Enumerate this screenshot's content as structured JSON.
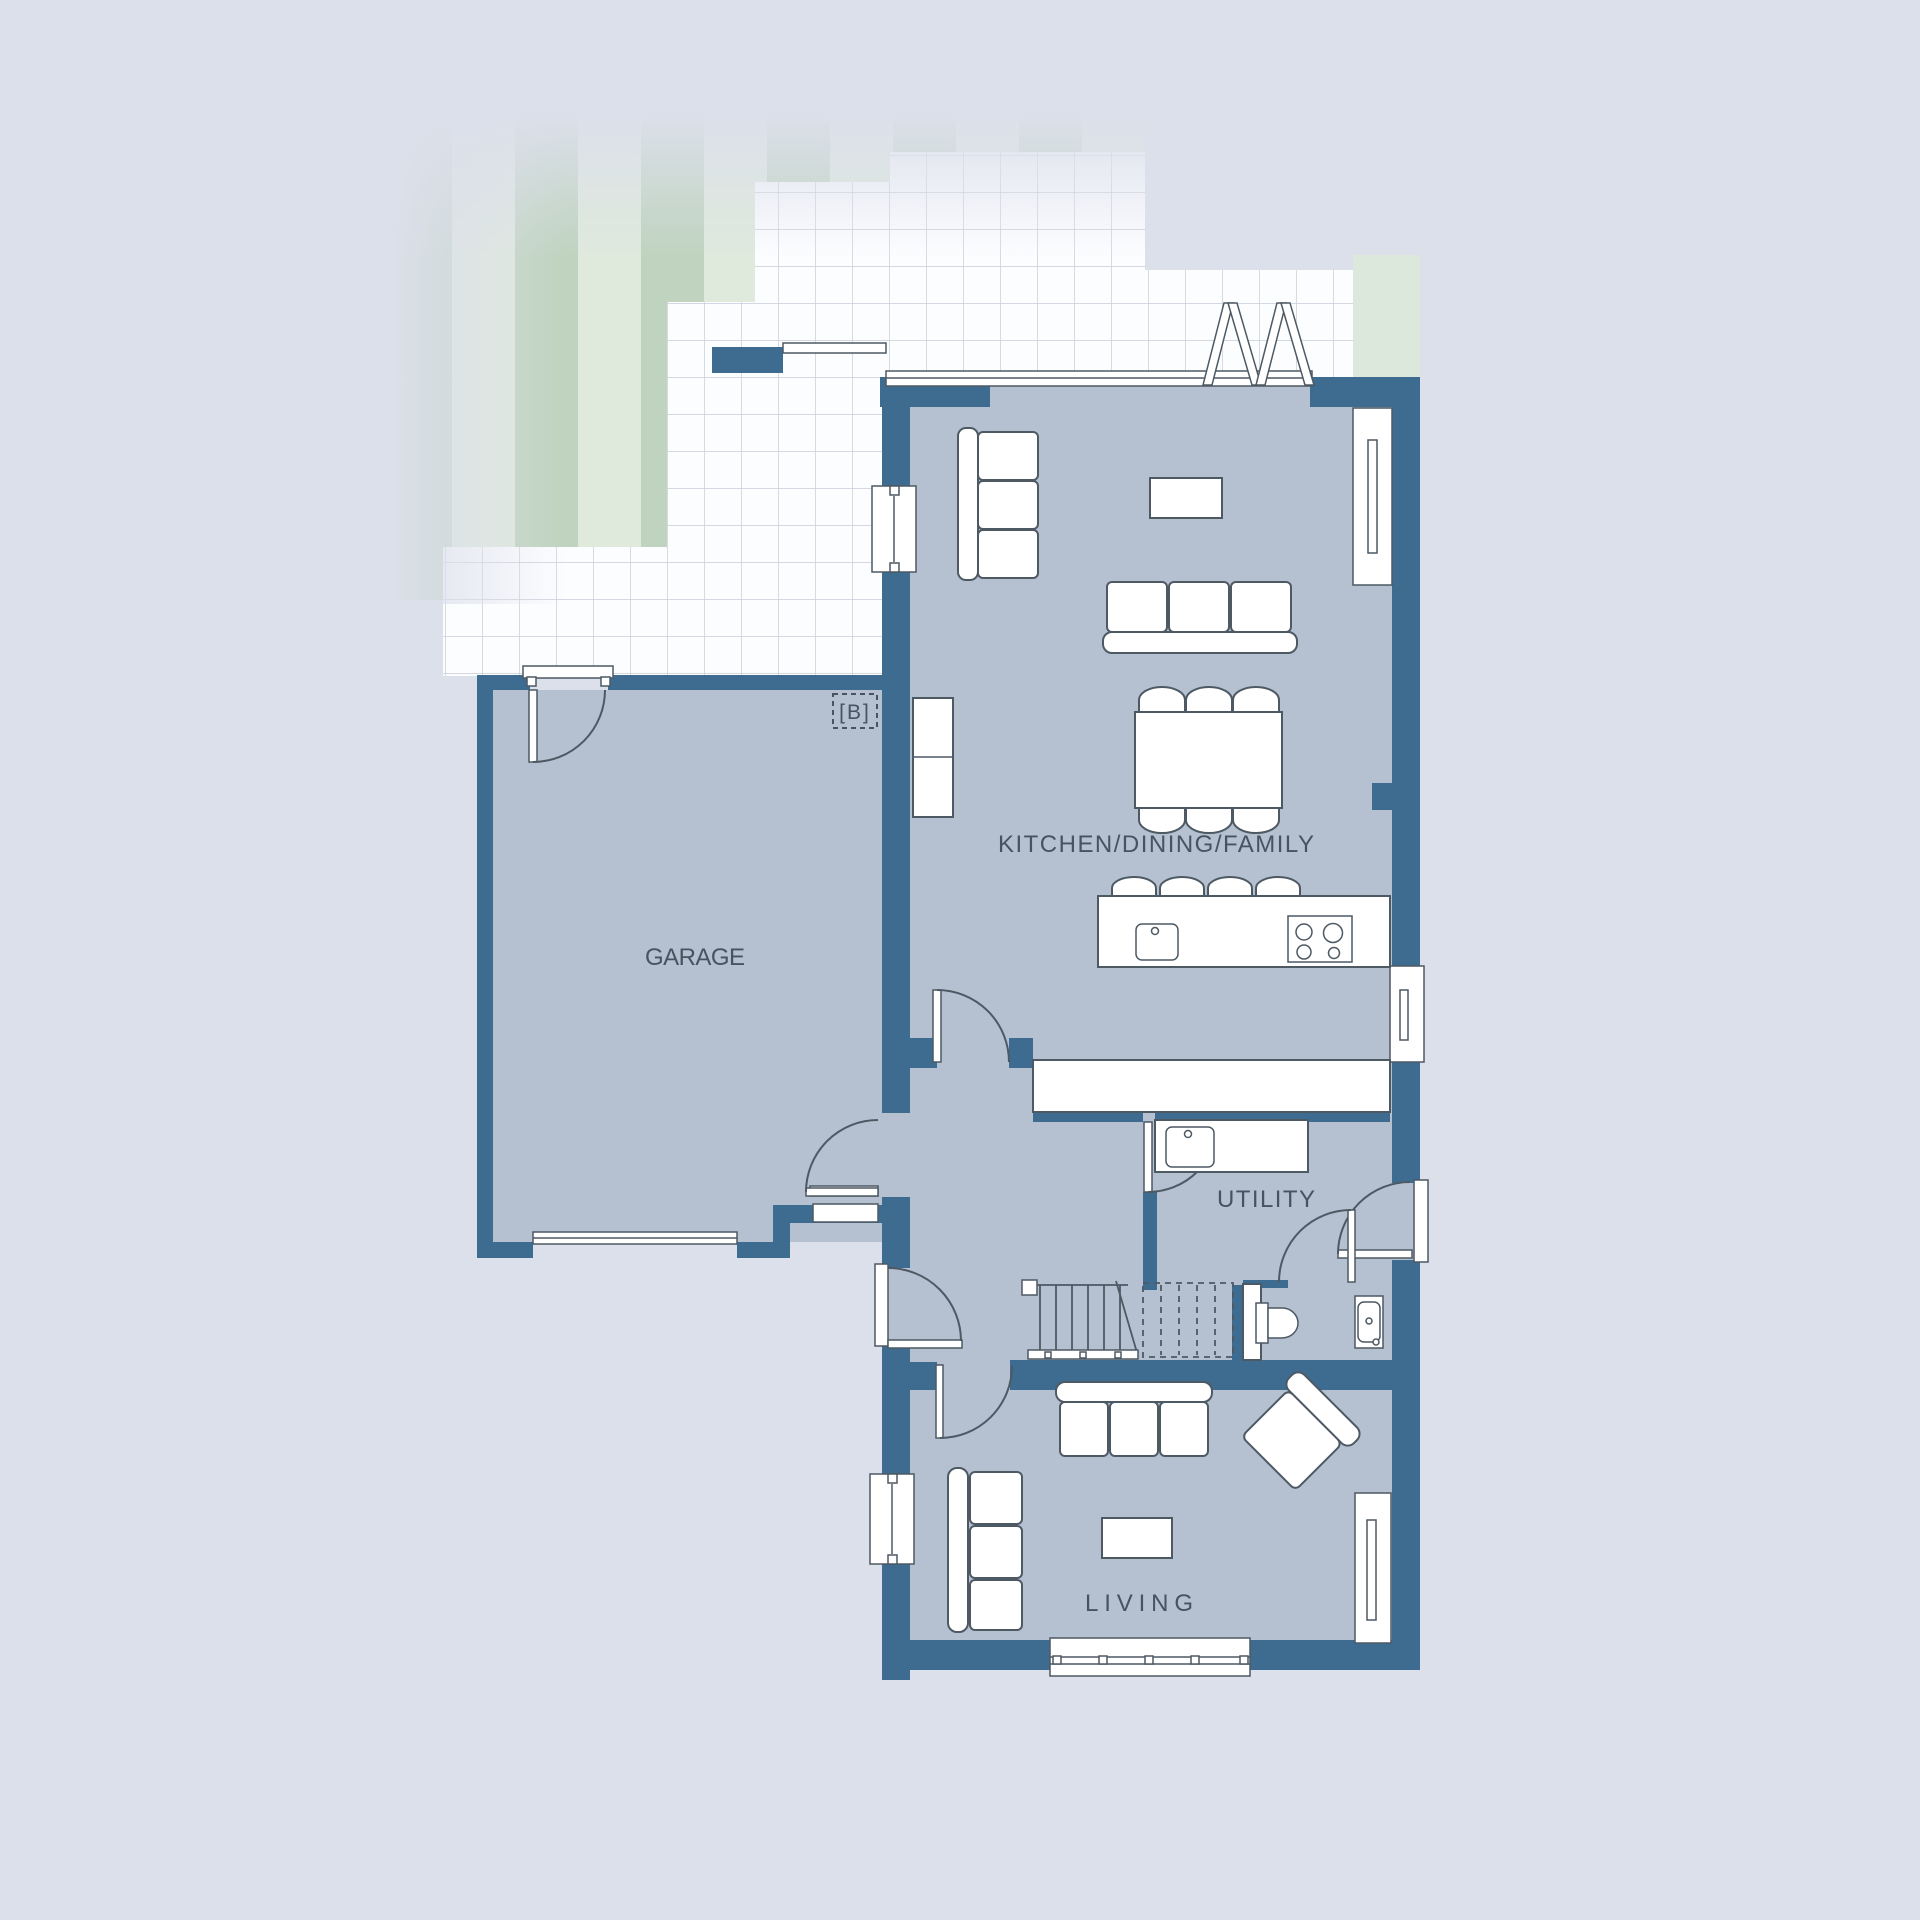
{
  "plan": {
    "marker": {
      "label": "[B]"
    },
    "rooms": {
      "garage": {
        "label": "GARAGE"
      },
      "kitchen": {
        "label": "KITCHEN/DINING/FAMILY"
      },
      "utility": {
        "label": "UTILITY"
      },
      "living": {
        "label": "LIVING"
      }
    },
    "colors": {
      "background": "#dce0eb",
      "wall": "#3e6c91",
      "room_fill": "#b5c0d1",
      "furniture_outline": "#4d5963",
      "label_text": "#47535e",
      "lawn_light": "#dfe9dc",
      "lawn_dark": "#bfd3be",
      "tile_line": "#c8ccd6"
    }
  }
}
